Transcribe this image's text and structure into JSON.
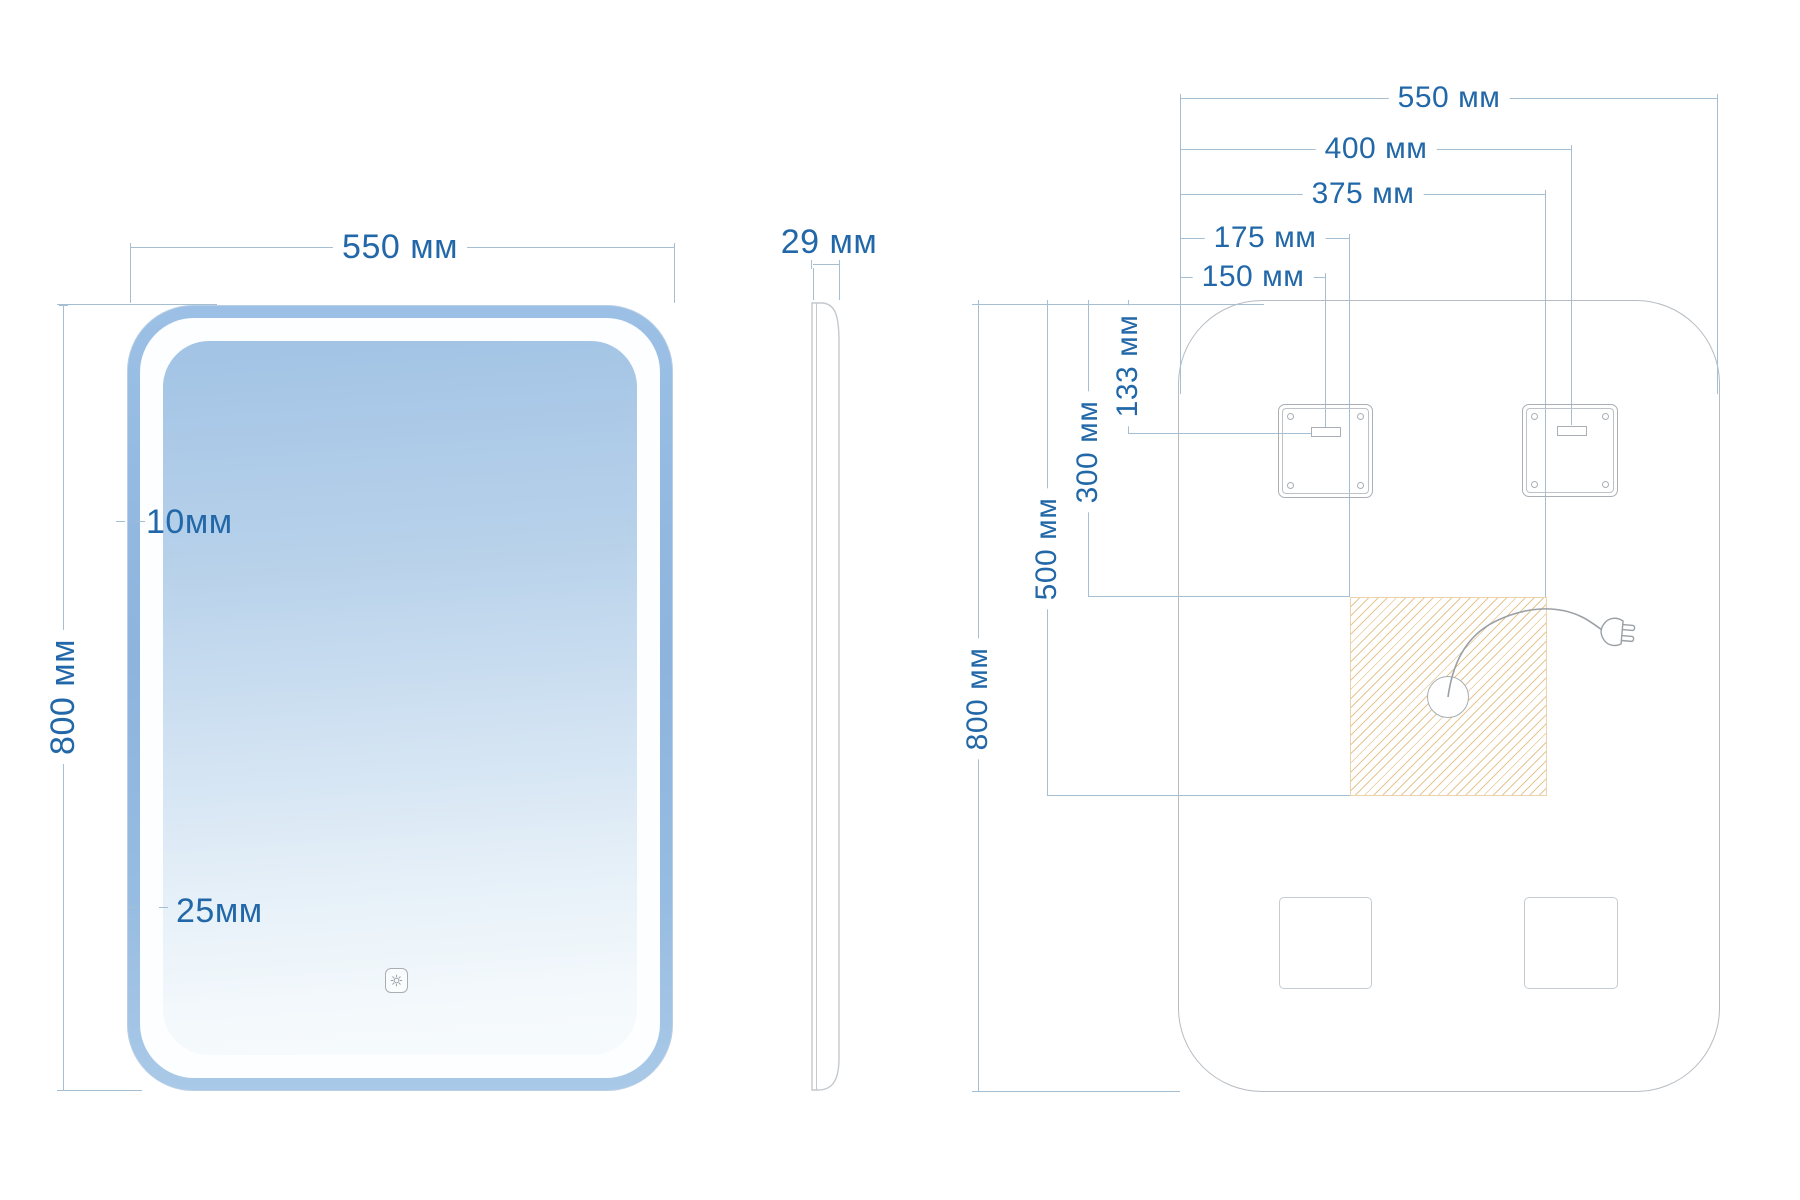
{
  "title": "LED mirror technical drawing",
  "units": "мм",
  "colors": {
    "accent": "#2268a8",
    "dim": "#a6bed2",
    "outline": "#b6bcc2",
    "bracket": "#a9afb4",
    "cable": "#9aa0a5",
    "led_band": "#8fb5de",
    "glass_top": "#a2c3e5",
    "glass_bottom": "#f6fafd",
    "hatch": "#e6c693"
  },
  "front_view": {
    "name": "front-view",
    "width_dim": "550 мм",
    "height_dim": "800 мм",
    "led_band_dim": "10мм",
    "frame_dim": "25мм"
  },
  "side_view": {
    "name": "side-view",
    "depth_dim": "29 мм"
  },
  "back_view": {
    "name": "back-view",
    "horizontal_dims": [
      {
        "id": "overall-width",
        "label": "550 мм"
      },
      {
        "id": "right-hanger-offset",
        "label": "400 мм"
      },
      {
        "id": "junction-area-right",
        "label": "375 мм"
      },
      {
        "id": "junction-area-left",
        "label": "175 мм"
      },
      {
        "id": "left-hanger-offset",
        "label": "150 мм"
      }
    ],
    "vertical_dims": [
      {
        "id": "hanger-top-offset",
        "label": "133 мм"
      },
      {
        "id": "junction-area-top",
        "label": "300 мм"
      },
      {
        "id": "junction-area-bottom",
        "label": "500 мм"
      },
      {
        "id": "overall-height",
        "label": "800 мм"
      }
    ]
  }
}
